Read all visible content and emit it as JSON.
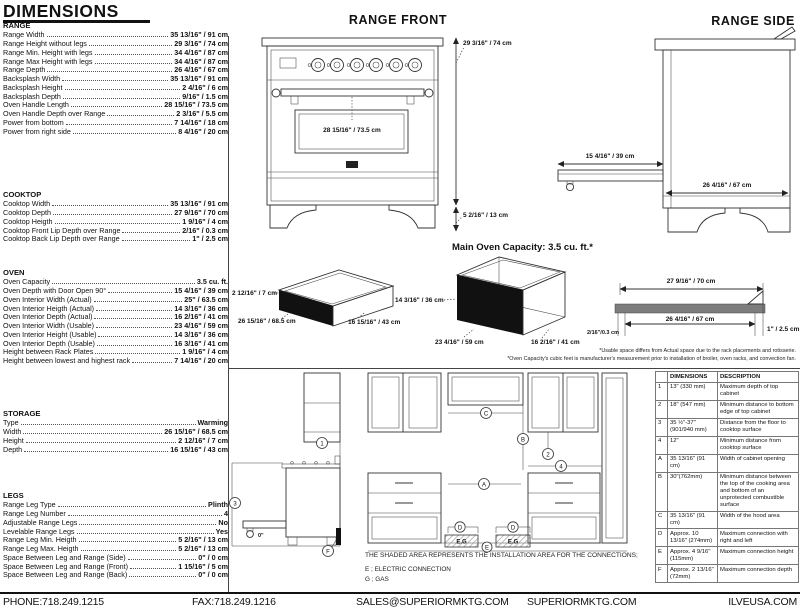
{
  "colors": {
    "ink": "#111111",
    "profile_bar": "#7d7d7d"
  },
  "page_title": "DIMENSIONS",
  "specs": [
    {
      "title": "RANGE",
      "rows": [
        {
          "label": "Range Width",
          "value": "35 13/16\" / 91 cm"
        },
        {
          "label": "Range Height without legs",
          "value": "29 3/16\" / 74 cm"
        },
        {
          "label": "Range Min. Height with legs",
          "value": "34 4/16\" / 87 cm"
        },
        {
          "label": "Range Max Height with legs",
          "value": "34 4/16\" / 87 cm"
        },
        {
          "label": "Range Depth",
          "value": "26 4/16\" / 67 cm"
        },
        {
          "label": "Backsplash Width",
          "value": "35 13/16\" / 91 cm"
        },
        {
          "label": "Backsplash Height",
          "value": "2 4/16\" / 6 cm"
        },
        {
          "label": "Backsplash Depth",
          "value": "9/16\" / 1.5 cm"
        },
        {
          "label": "Oven Handle Length",
          "value": "28 15/16\" / 73.5 cm"
        },
        {
          "label": "Oven Handle Depth over Range",
          "value": "2 3/16\" / 5.5 cm"
        },
        {
          "label": "Power from bottom",
          "value": "7 14/16\" / 18 cm"
        },
        {
          "label": "Power from right side",
          "value": "8 4/16\" / 20 cm"
        }
      ]
    },
    {
      "title": "COOKTOP",
      "rows": [
        {
          "label": "Cooktop Width",
          "value": "35 13/16\" / 91 cm"
        },
        {
          "label": "Cooktop Depth",
          "value": "27 9/16\" / 70 cm"
        },
        {
          "label": "Cooktop Heigth",
          "value": "1 9/16\" / 4 cm"
        },
        {
          "label": "Cooktop Front Lip Depth over Range",
          "value": "2/16\" / 0.3 cm"
        },
        {
          "label": "Cooktop Back Lip Depth over Range",
          "value": "1\" / 2.5 cm"
        }
      ]
    },
    {
      "title": "OVEN",
      "rows": [
        {
          "label": "Oven Capacity",
          "value": "3.5 cu. ft."
        },
        {
          "label": "Oven Depth with Door Open 90°",
          "value": "15 4/16\" / 39 cm"
        },
        {
          "label": "Oven Interior Width (Actual)",
          "value": "25\" / 63.5 cm"
        },
        {
          "label": "Oven Interior Heigth (Actual)",
          "value": "14 3/16\" / 36 cm"
        },
        {
          "label": "Oven Interior Depth (Actual)",
          "value": "16 2/16\" / 41 cm"
        },
        {
          "label": "Oven Interior Width (Usable)",
          "value": "23 4/16\" / 59 cm"
        },
        {
          "label": "Oven Interior Height (Usable)",
          "value": "14 3/16\" / 36 cm"
        },
        {
          "label": "Oven Interior Depth (Usable)",
          "value": "16 3/16\" / 41 cm"
        },
        {
          "label": "Height between Rack Plates",
          "value": "1 9/16\" / 4 cm"
        },
        {
          "label": "Height between lowest and highest rack",
          "value": "7 14/16\" / 20 cm"
        }
      ]
    },
    {
      "title": "STORAGE",
      "rows": [
        {
          "label": "Type",
          "value": "Warming"
        },
        {
          "label": "Width",
          "value": "26 15/16\" / 68.5 cm"
        },
        {
          "label": "Height",
          "value": "2 12/16\" / 7 cm"
        },
        {
          "label": "Depth",
          "value": "16 15/16\" / 43 cm"
        }
      ]
    },
    {
      "title": "LEGS",
      "rows": [
        {
          "label": "Range Leg Type",
          "value": "Plinth"
        },
        {
          "label": "Range Leg Number",
          "value": "4"
        },
        {
          "label": "Adjustable Range Legs",
          "value": "No"
        },
        {
          "label": "Levelable Range Legs",
          "value": "Yes"
        },
        {
          "label": "Range Leg Min. Heigth",
          "value": "5 2/16\" / 13 cm"
        },
        {
          "label": "Range Leg Max. Heigth",
          "value": "5 2/16\" / 13 cm"
        },
        {
          "label": "Space Between Leg and Range (Side)",
          "value": "0\" / 0 cm"
        },
        {
          "label": "Space Between Leg and Range (Front)",
          "value": "1 15/16\" / 5 cm"
        },
        {
          "label": "Space Between Leg and Range (Back)",
          "value": "0\" / 0 cm"
        }
      ]
    }
  ],
  "front_view": {
    "title": "RANGE FRONT",
    "height_label": "29 3/16\" / 74 cm",
    "handle_label": "28 15/16\" / 73.5 cm",
    "legs_label": "5 2/16\" / 13 cm"
  },
  "side_view": {
    "title": "RANGE SIDE",
    "door_open_label": "15 4/16\" / 39 cm",
    "depth_label": "26 4/16\" / 67 cm"
  },
  "capacity": {
    "heading": "Main Oven Capacity: 3.5 cu. ft.*",
    "drawer": {
      "height": "2 12/16\" / 7 cm",
      "width": "26 15/16\" / 68.5 cm",
      "depth": "16 15/16\" / 43 cm"
    },
    "oven": {
      "height": "14 3/16\" / 36 cm",
      "width": "23 4/16\" / 59 cm",
      "depth": "16 2/16\" / 41 cm"
    },
    "profile": {
      "top_width": "27 9/16\" / 70 cm",
      "inner_width": "26 4/16\" / 67 cm",
      "front_lip": "2/16\"/0.3 cm",
      "back_lip": "1\" / 2.5 cm"
    },
    "footnotes": [
      "*Usable space differs from Actual space due to the rack placements and rotisserie.",
      "*Oven Capacity's cubic feet is manufacturer's measurement prior to installation of broiler, oven racks, and convection fan."
    ]
  },
  "installation": {
    "note": "THE SHADED AREA REPRESENTS THE INSTALLATION AREA FOR THE CONNECTIONS;",
    "legend_electric": "E ; ELECTRIC CONNECTION",
    "legend_gas": "G ; GAS",
    "markers": {
      "one": "1",
      "two": "2",
      "three": "3",
      "four": "4",
      "a": "A",
      "b": "B",
      "c": "C",
      "d": "D",
      "e": "E",
      "f": "F",
      "eg": "E.G",
      "zero": "0\""
    }
  },
  "dim_table": {
    "header_dimensions": "DIMENSIONS",
    "header_description": "DESCRIPTION",
    "rows": [
      {
        "ref": "1",
        "dimension": "13\" (330 mm)",
        "description": "Maximum depth of top cabinet"
      },
      {
        "ref": "2",
        "dimension": "18\" (547 mm)",
        "description": "Minimum distance to bottom edge of top cabinet"
      },
      {
        "ref": "3",
        "dimension": "35 ½\"-37\" (901/940 mm)",
        "description": "Distance from the floor to cooktop surface"
      },
      {
        "ref": "4",
        "dimension": "12\"",
        "description": "Minimum distance from cooktop surface"
      },
      {
        "ref": "A",
        "dimension": "35 13/16\" (91 cm)",
        "description": "Width of cabinet opening"
      },
      {
        "ref": "B",
        "dimension": "30\"(762mm)",
        "description": "Minimum distance between the top of the cooking area and bottom of an unprotected combustible surface"
      },
      {
        "ref": "C",
        "dimension": "35 13/16\" (91 cm)",
        "description": "Width of the hood area"
      },
      {
        "ref": "D",
        "dimension": "Approx. 10 13/16\" (274mm)",
        "description": "Maximum connection with right and left"
      },
      {
        "ref": "E",
        "dimension": "Approx. 4 9/16\" (115mm)",
        "description": "Maximum connection height"
      },
      {
        "ref": "F",
        "dimension": "Approx. 2 13/16\" (72mm)",
        "description": "Maximum connection depth"
      }
    ]
  },
  "footer": {
    "phone": "PHONE:718.249.1215",
    "fax": "FAX:718.249.1216",
    "email": "SALES@SUPERIORMKTG.COM",
    "website": "SUPERIORMKTG.COM",
    "brand": "ILVEUSA.COM"
  }
}
